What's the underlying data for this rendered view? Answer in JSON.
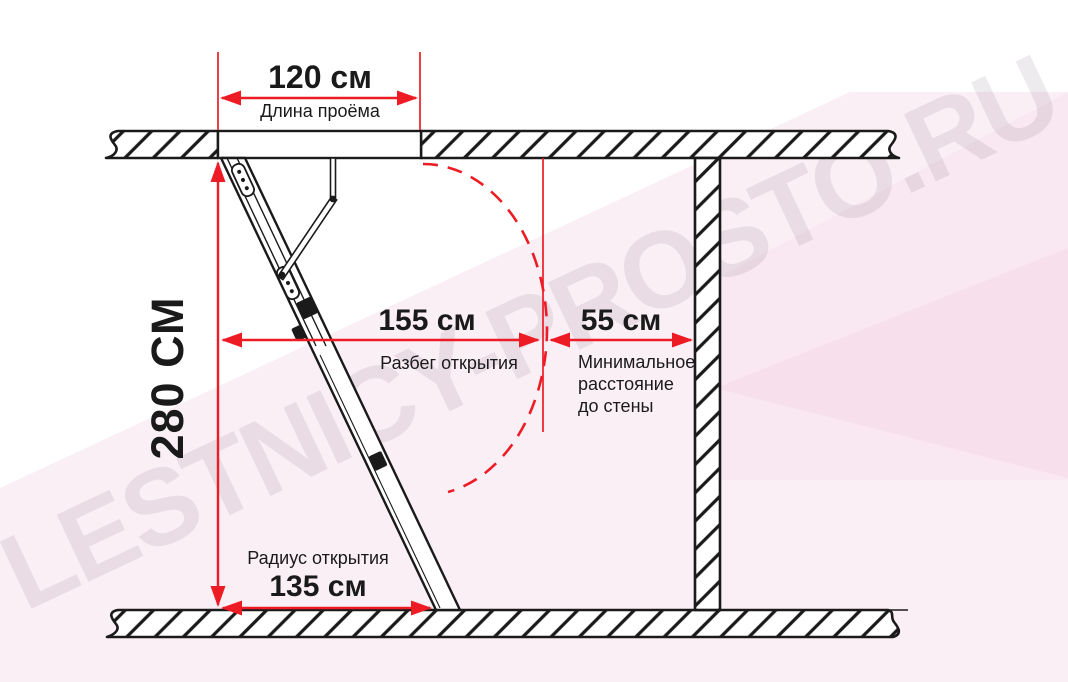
{
  "figure": {
    "type": "technical-diagram",
    "subject": "attic folding ladder opening dimensions, side view"
  },
  "watermark": {
    "text": "LESTNICY-PROSTO.RU"
  },
  "dimensions": {
    "opening_length": {
      "value": "120 см",
      "label": "Длина проёма"
    },
    "ceiling_height": {
      "value": "280 СМ"
    },
    "opening_run": {
      "value": "155 см",
      "label": "Разбег открытия"
    },
    "wall_distance": {
      "value": "55 см",
      "label": "Минимальное\nрасстояние\nдо стены"
    },
    "opening_radius": {
      "value": "135 см",
      "label": "Радиус открытия"
    }
  },
  "icons": {
    "dimension_arrowhead": "red filled triangle",
    "hatch_pattern": "diagonal 45° section hatching"
  },
  "colors": {
    "dimension_red": "#ed1c24",
    "line_black": "#1a1a1a",
    "background_pink": "#fbeff6",
    "background_pink_deep": "#f8e6f0",
    "background_pink_deepest": "#f6ddeb",
    "watermark_gray": "#e9e3e8"
  }
}
